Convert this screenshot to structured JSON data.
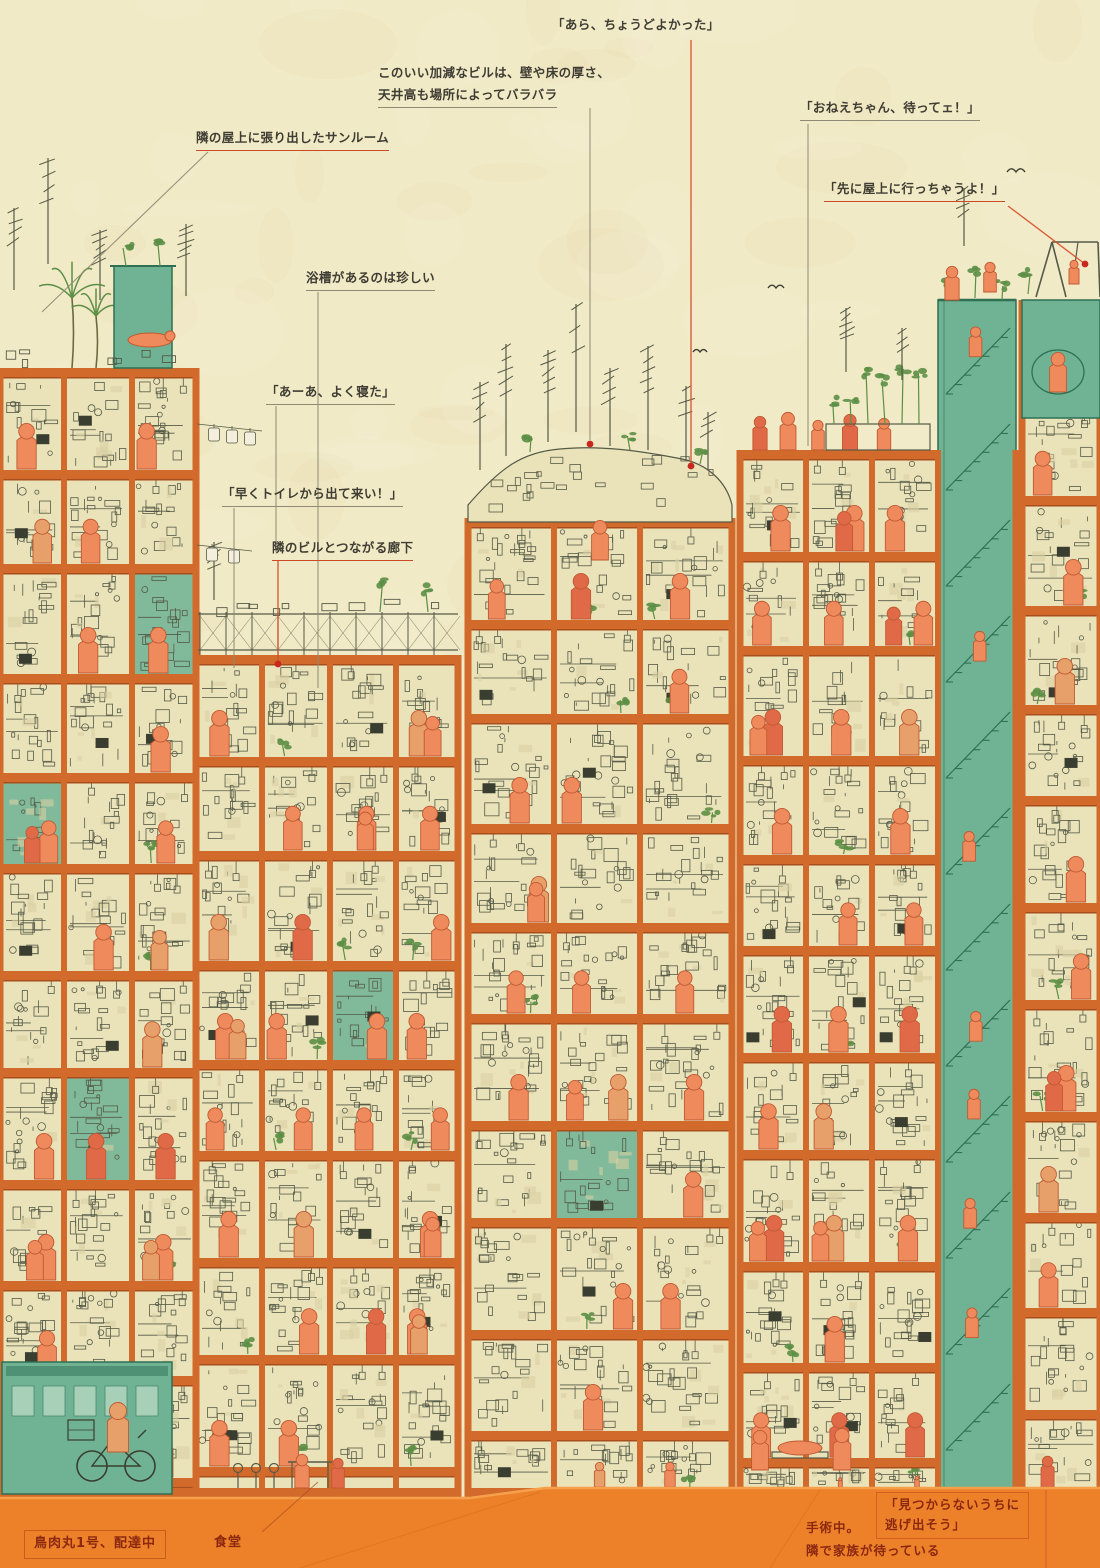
{
  "illustration": {
    "title": "kowloon-walled-city-cross-section",
    "annotations": {
      "ara": "「あら、ちょうどよかった」",
      "building_line1": "このいい加減なビルは、壁や床の厚さ、",
      "building_line2": "天井高も場所によってバラバラ",
      "oneechan": "「おねえちゃん、待ってェ！」",
      "sunroom": "隣の屋上に張り出したサンルーム",
      "rooftop": "「先に屋上に行っちゃうよ！」",
      "bathtub": "浴槽があるのは珍しい",
      "sleep": "「あーあ、よく寝た」",
      "toilet": "「早くトイレから出て来い！」",
      "corridor": "隣のビルとつながる廊下"
    },
    "street_labels": {
      "delivery": "鳥肉丸1号、配達中",
      "diner": "食堂",
      "surgery_line1": "手術中。",
      "surgery_line2": "隣で家族が待っている",
      "escape_line1": "「見つからないうちに",
      "escape_line2": "逃げ出そう」"
    },
    "palette": {
      "paper": "#f1eac6",
      "paper_mottle": "#cfc491",
      "room": "#eae3ba",
      "clutter_fill": "#d8d0a4",
      "slab": "#d26a2c",
      "slab_dark": "#a84e1c",
      "ground": "#ec8129",
      "ground_light": "#f6a04c",
      "ground_shade": "#c05f12",
      "teal": "#6fb394",
      "teal_dark": "#2f6f54",
      "teal_light": "#cfe4d2",
      "ink": "#555a47",
      "dark": "#3a3e30",
      "person": "#ee8a5c",
      "person_alt": "#e8a06a",
      "person_red": "#e06a48",
      "person_dark": "#c05a33",
      "accent_red": "#c8281e",
      "label_ink": "#3f3d33",
      "street_label_ink": "#8c2810",
      "leader_gray": "#8f8a74",
      "leader_orange": "#d4512c",
      "plant": "#5c8f45",
      "laundry": "#f4efdd"
    }
  }
}
